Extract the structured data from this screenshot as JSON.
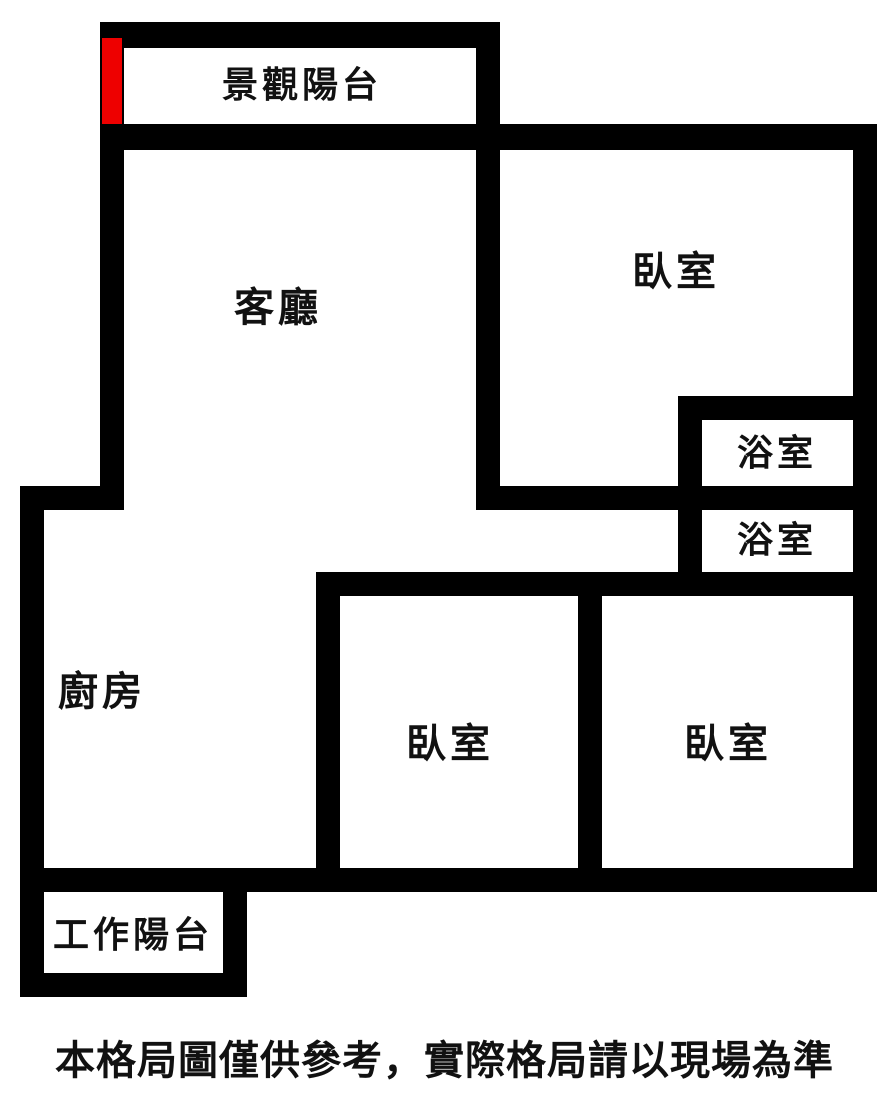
{
  "colors": {
    "wall": "#000000",
    "background": "#ffffff",
    "entrance_marker": "#ee0000",
    "text": "#111111"
  },
  "rooms": {
    "scenic_balcony": "景觀陽台",
    "living_room": "客廳",
    "bedroom_top": "臥室",
    "bathroom_upper": "浴室",
    "bathroom_lower": "浴室",
    "kitchen": "廚房",
    "bedroom_middle": "臥室",
    "bedroom_right": "臥室",
    "work_balcony": "工作陽台"
  },
  "disclaimer": "本格局圖僅供參考，實際格局請以現場為準"
}
